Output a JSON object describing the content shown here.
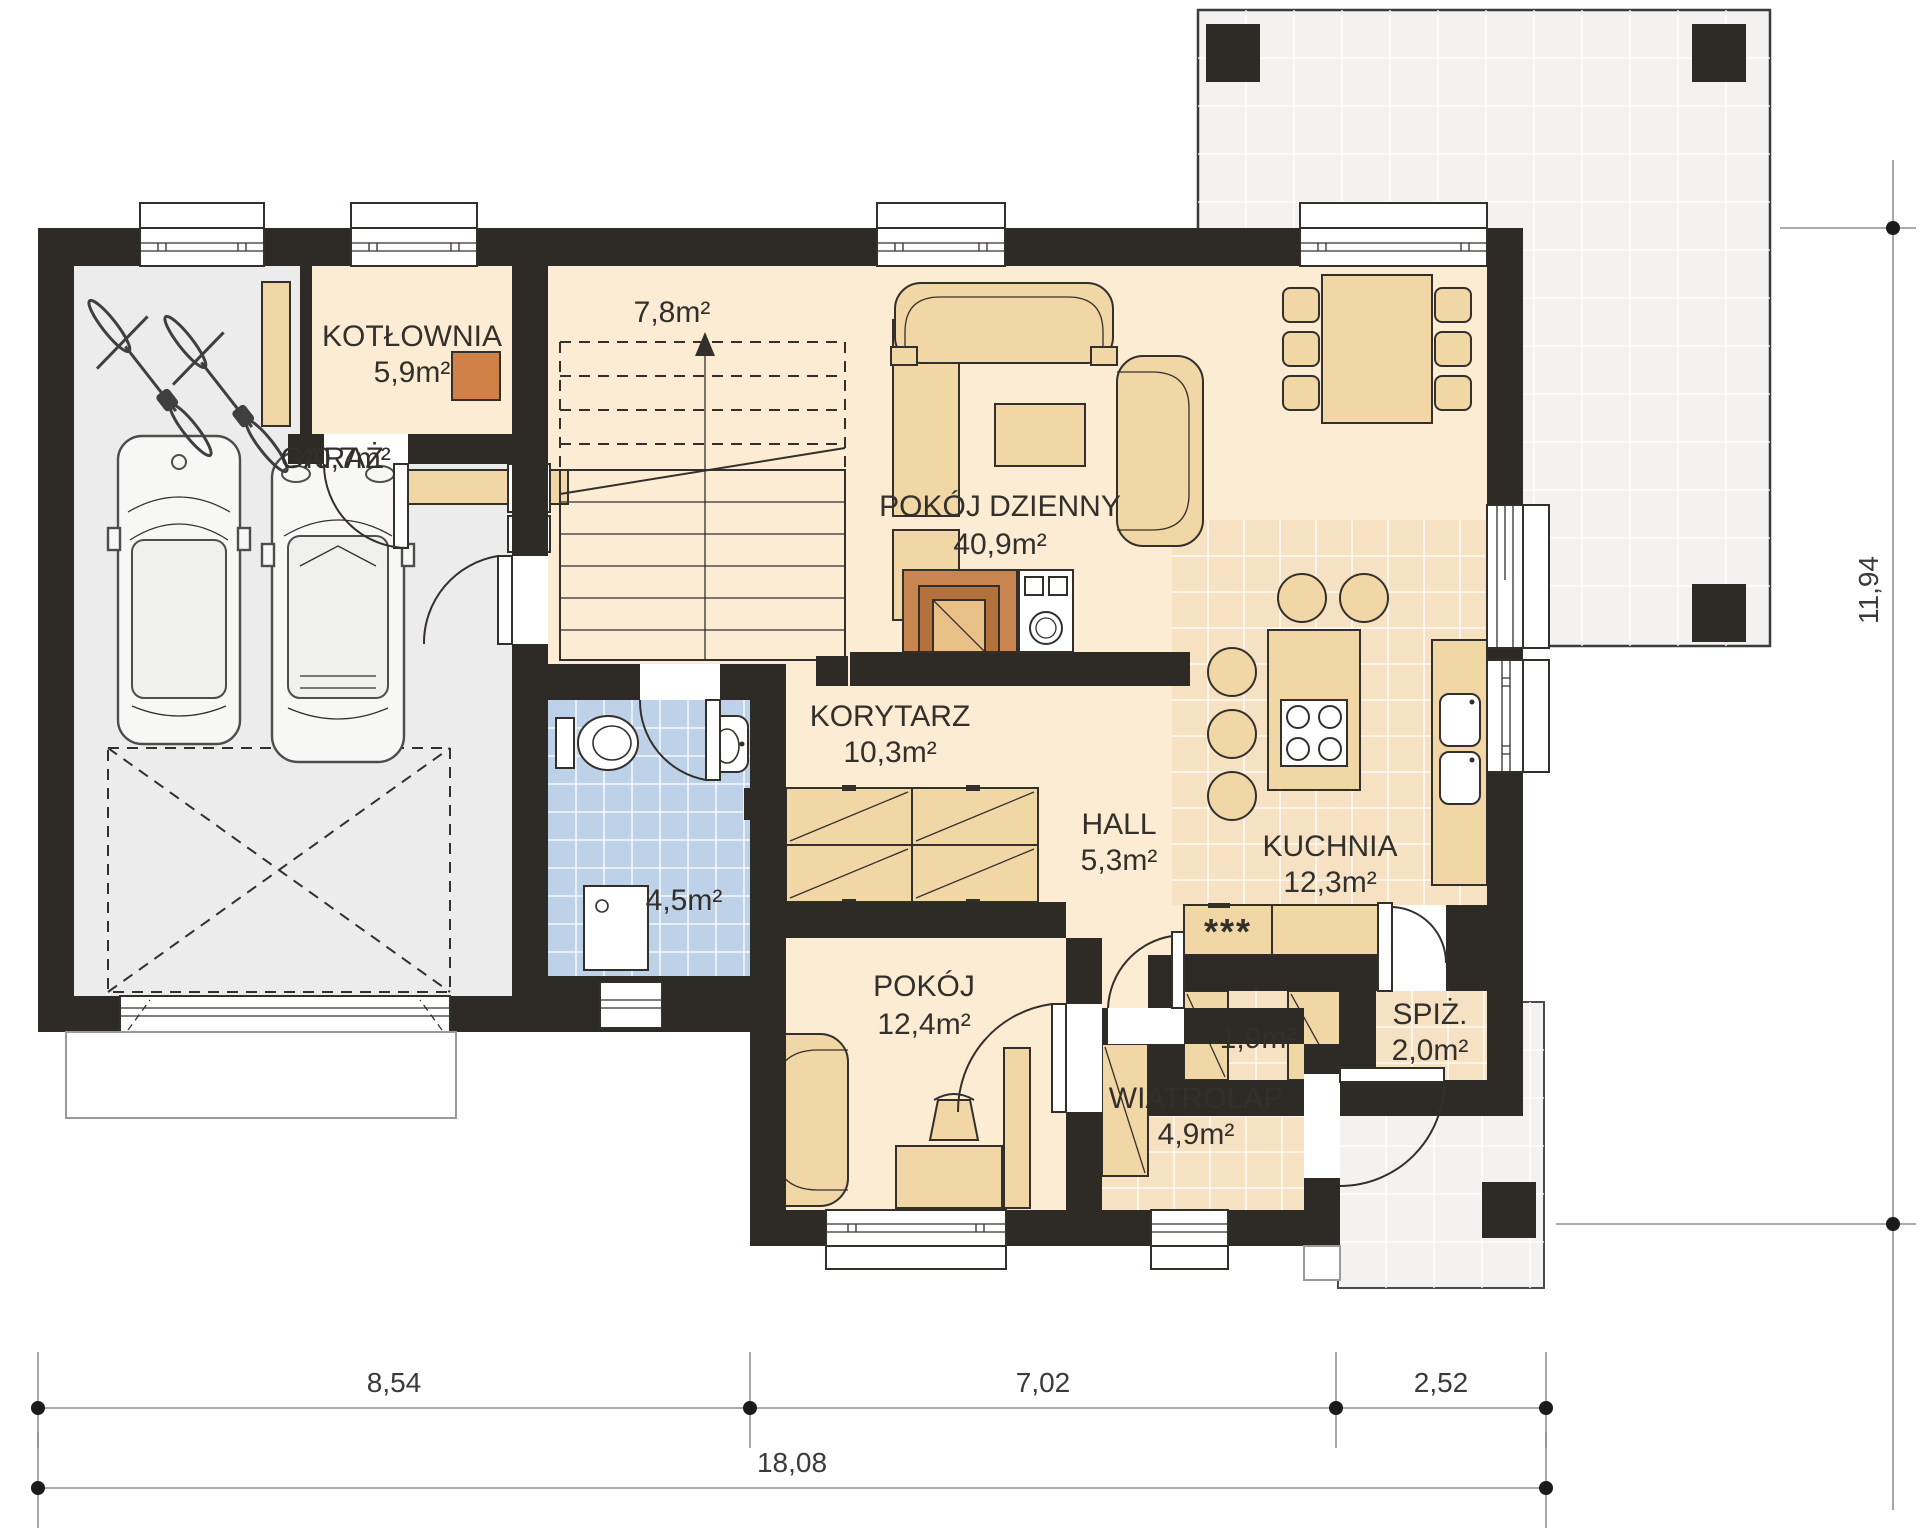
{
  "plan": {
    "rooms": {
      "kotlownia": {
        "name": "KOTŁOWNIA",
        "area": "5,9m²"
      },
      "garaz": {
        "name": "GARAŻ",
        "area": "40,7m²"
      },
      "schody": {
        "area": "7,8m²"
      },
      "pokoj_dzienny": {
        "name": "POKÓJ DZIENNY",
        "area": "40,9m²"
      },
      "korytarz": {
        "name": "KORYTARZ",
        "area": "10,3m²"
      },
      "hall": {
        "name": "HALL",
        "area": "5,3m²"
      },
      "kuchnia": {
        "name": "KUCHNIA",
        "area": "12,3m²"
      },
      "lazienka": {
        "area": "4,5m²"
      },
      "pokoj": {
        "name": "POKÓJ",
        "area": "12,4m²"
      },
      "garderoba": {
        "area": "1,9m²"
      },
      "spizarnia": {
        "name": "SPIŻ.",
        "area": "2,0m²"
      },
      "wiatrolap": {
        "name": "WIATROŁAP",
        "area": "4,9m²"
      }
    },
    "symbols": {
      "appliance_marker": "***"
    },
    "dimensions": {
      "bottom_segments": [
        "8,54",
        "7,02",
        "2,52"
      ],
      "bottom_total": "18,08",
      "right_height": "11,94"
    },
    "colors": {
      "wall": "#2e2a26",
      "room_cream": "#fbecd3",
      "tile_cream": "#f6e2c3",
      "furniture_tan": "#f1d6a6",
      "bath_blue": "#bdd2e9",
      "garage_gray": "#ececec",
      "terrace_gray": "#f3f2f0",
      "boiler_orange": "#d08148",
      "fireplace_brown": "#c9854f"
    }
  }
}
